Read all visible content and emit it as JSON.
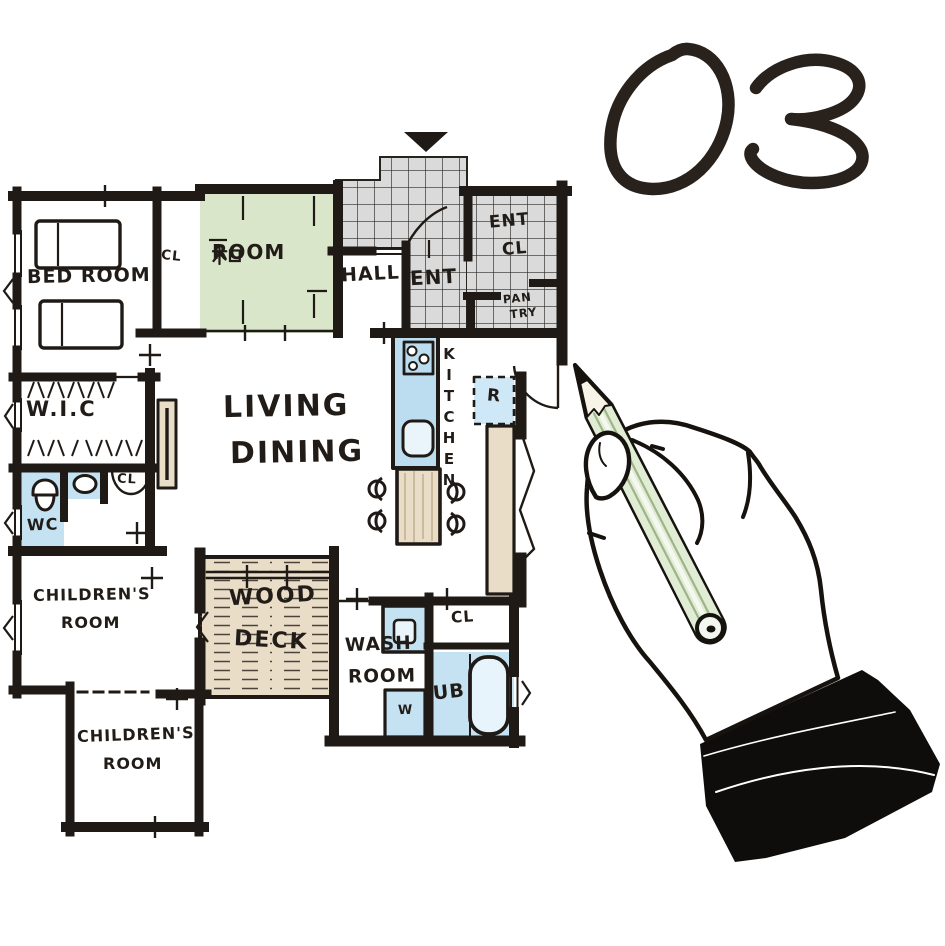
{
  "plan_number": "03",
  "rooms": {
    "bedroom": {
      "label": "BED ROOM"
    },
    "closet_bedroom": {
      "label": "CL"
    },
    "japanese_room": {
      "full_label": "和ROOM",
      "suffix": "ROOM"
    },
    "hall": {
      "label": "HALL"
    },
    "entrance": {
      "label": "ENT"
    },
    "entrance_closet": {
      "line1": "ENT",
      "line2": "CL"
    },
    "pantry": {
      "line1": "PAN",
      "line2": "TRY"
    },
    "walk_in_closet": {
      "label": "W.I.C"
    },
    "toilet": {
      "label": "WC"
    },
    "closet_hall": {
      "label": "CL"
    },
    "living_dining": {
      "line1": "LIVING",
      "line2": "DINING"
    },
    "kitchen": {
      "label": "KITCHEN"
    },
    "refrigerator": {
      "label": "R"
    },
    "children_room_1": {
      "line1": "CHILDREN'S",
      "line2": "ROOM"
    },
    "children_room_2": {
      "line1": "CHILDREN'S",
      "line2": "ROOM"
    },
    "wood_deck": {
      "line1": "WOOD",
      "line2": "DECK"
    },
    "wash_room": {
      "line1": "WASH",
      "line2": "ROOM"
    },
    "washing_machine": {
      "label": "W"
    },
    "closet_washroom": {
      "label": "CL"
    },
    "unit_bath": {
      "label": "UB"
    }
  },
  "colors": {
    "tatami_green": "#d9e6ca",
    "tile_gray": "#dadada",
    "water_blue": "#c5e2f3",
    "wood_beige": "#e9ddc8",
    "pencil_green": "#e1ecd5",
    "ink_black": "#1f1a16"
  }
}
